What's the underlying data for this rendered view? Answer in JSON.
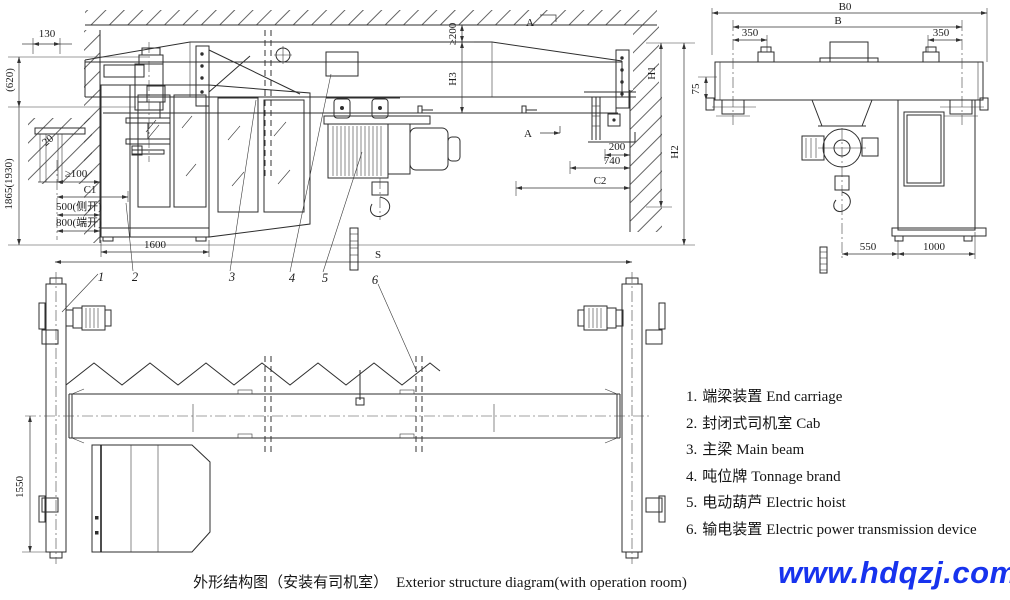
{
  "front": {
    "d130": "130",
    "d620": "(620)",
    "d1865": "1865(1930)",
    "d20": "20",
    "d_ge100": "≥100",
    "d_c1": "C1",
    "d_500": "500(侧开)",
    "d_800": "800(端开)",
    "d_1600": "1600",
    "d_ge200": "≥200",
    "d_h3": "H3",
    "section": "A",
    "d_200": "200",
    "d_740": "740",
    "d_c2": "C2",
    "d_h1": "H1",
    "d_h2": "H2",
    "d_s": "S"
  },
  "side": {
    "d_b0": "B0",
    "d_b": "B",
    "d_350l": "350",
    "d_350r": "350",
    "d_75": "75",
    "d_550": "550",
    "d_1000": "1000"
  },
  "plan": {
    "d_1550": "1550"
  },
  "leaders": [
    "1",
    "2",
    "3",
    "4",
    "5",
    "6"
  ],
  "legend": {
    "items": [
      {
        "num": "1.",
        "zh": "端梁装置",
        "en": "End carriage"
      },
      {
        "num": "2.",
        "zh": "封闭式司机室",
        "en": "Cab"
      },
      {
        "num": "3.",
        "zh": "主梁",
        "en": "Main beam"
      },
      {
        "num": "4.",
        "zh": "吨位牌",
        "en": "Tonnage brand"
      },
      {
        "num": "5.",
        "zh": "电动葫芦",
        "en": "Electric hoist"
      },
      {
        "num": "6.",
        "zh": "输电装置",
        "en": "Electric power transmission device"
      }
    ]
  },
  "caption": {
    "zh": "外形结构图（安装有司机室）",
    "en": "Exterior structure diagram(with operation room)"
  },
  "watermark": {
    "text": "www.hdqzj.com",
    "color": "#1733ee"
  }
}
